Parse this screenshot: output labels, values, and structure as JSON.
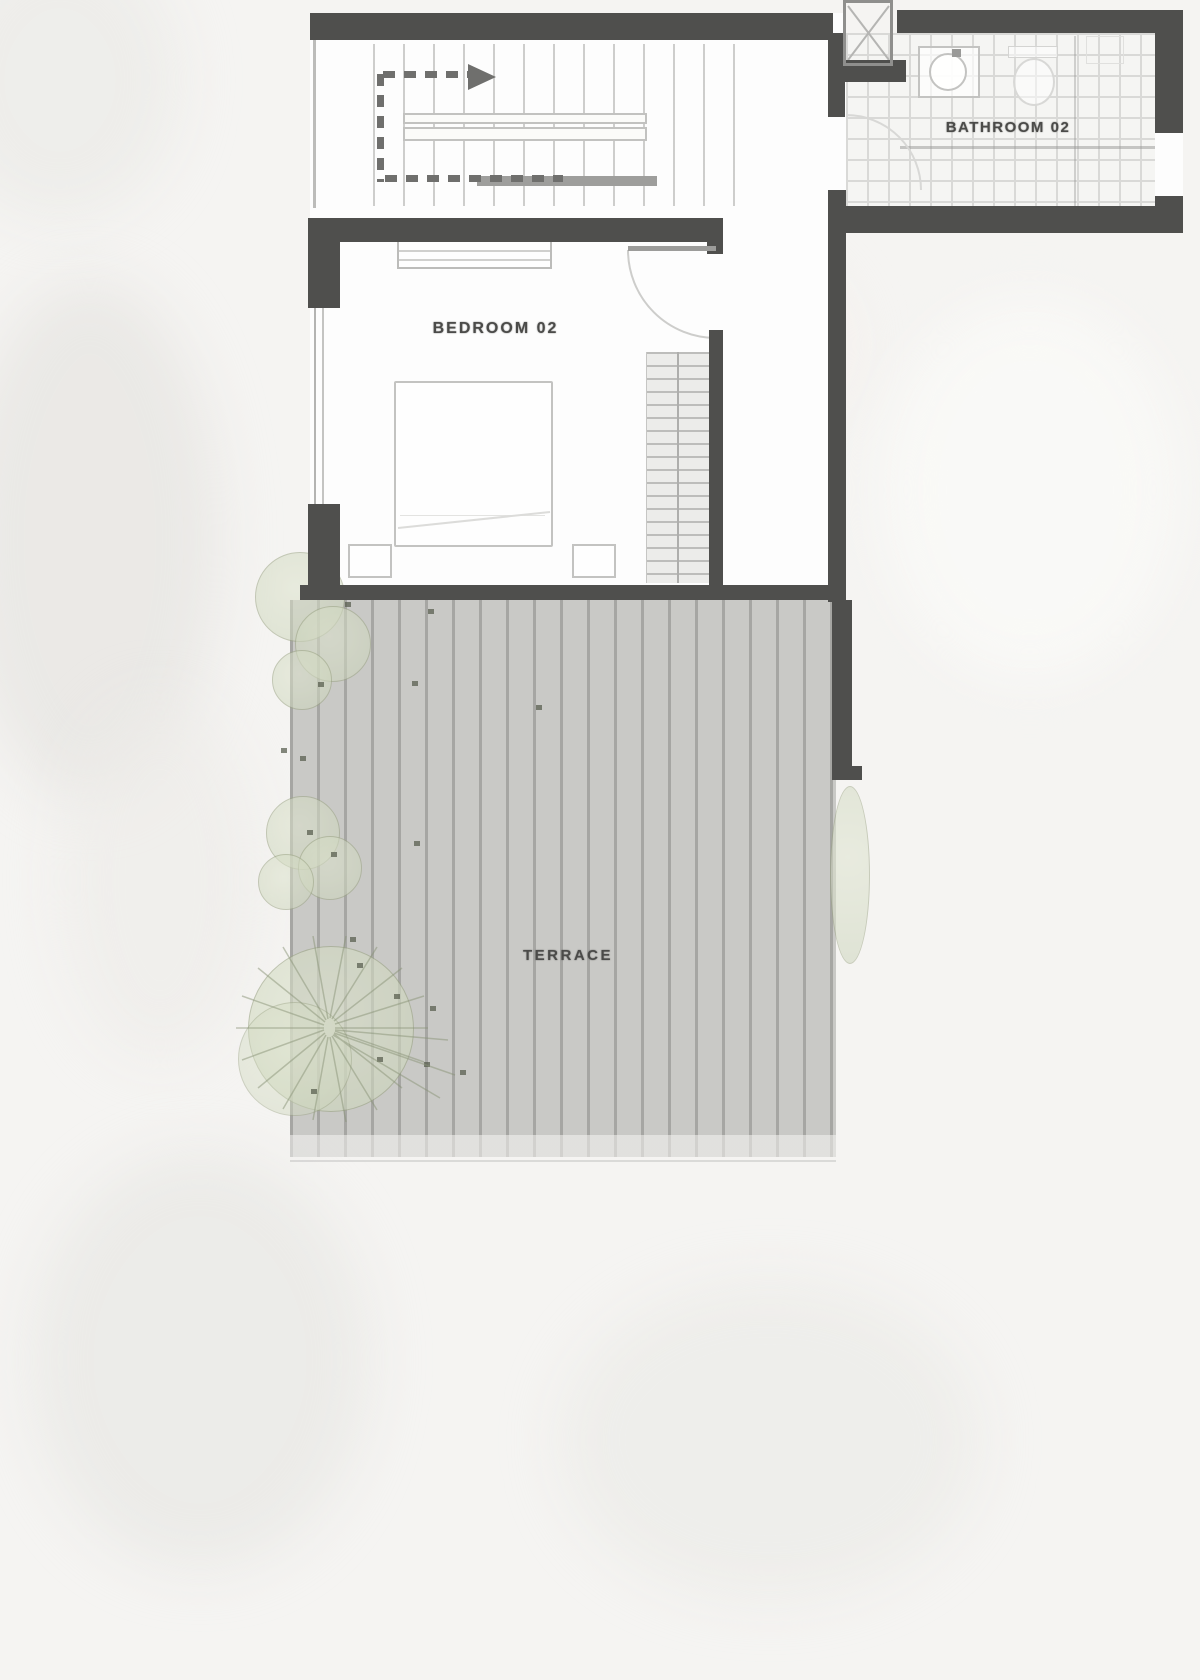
{
  "plan": {
    "type": "residential-floor-plan-upper-level",
    "labels": {
      "bedroom": "BEDROOM 02",
      "bathroom": "BATHROOM 02",
      "terrace": "TERRACE"
    },
    "features": {
      "stair": "staircase-with-up-direction-arrow",
      "bedroom_furniture": [
        "bed",
        "nightstand-left",
        "nightstand-right",
        "wardrobe",
        "shelf"
      ],
      "bathroom_fixtures": [
        "sink",
        "toilet"
      ],
      "landscape": [
        "shrub-cluster-upper",
        "shrub-cluster-middle",
        "tree-large",
        "planting-strip-right"
      ]
    }
  },
  "colors": {
    "background": "#f5f4f2",
    "floor": "#fdfdfd",
    "wall": "#4f4f4d",
    "deck_board": "#c9c9c6",
    "deck_gap": "#a6a6a3",
    "tile_line": "#d9d9d7",
    "stair_line": "#c5c5c3",
    "furniture_line": "#c3c3c1",
    "direction_line": "#6f6f6d",
    "label_text": "#4b4b49",
    "plant_fill": "#d5dcc4",
    "plant_dot": "#565b4c"
  }
}
